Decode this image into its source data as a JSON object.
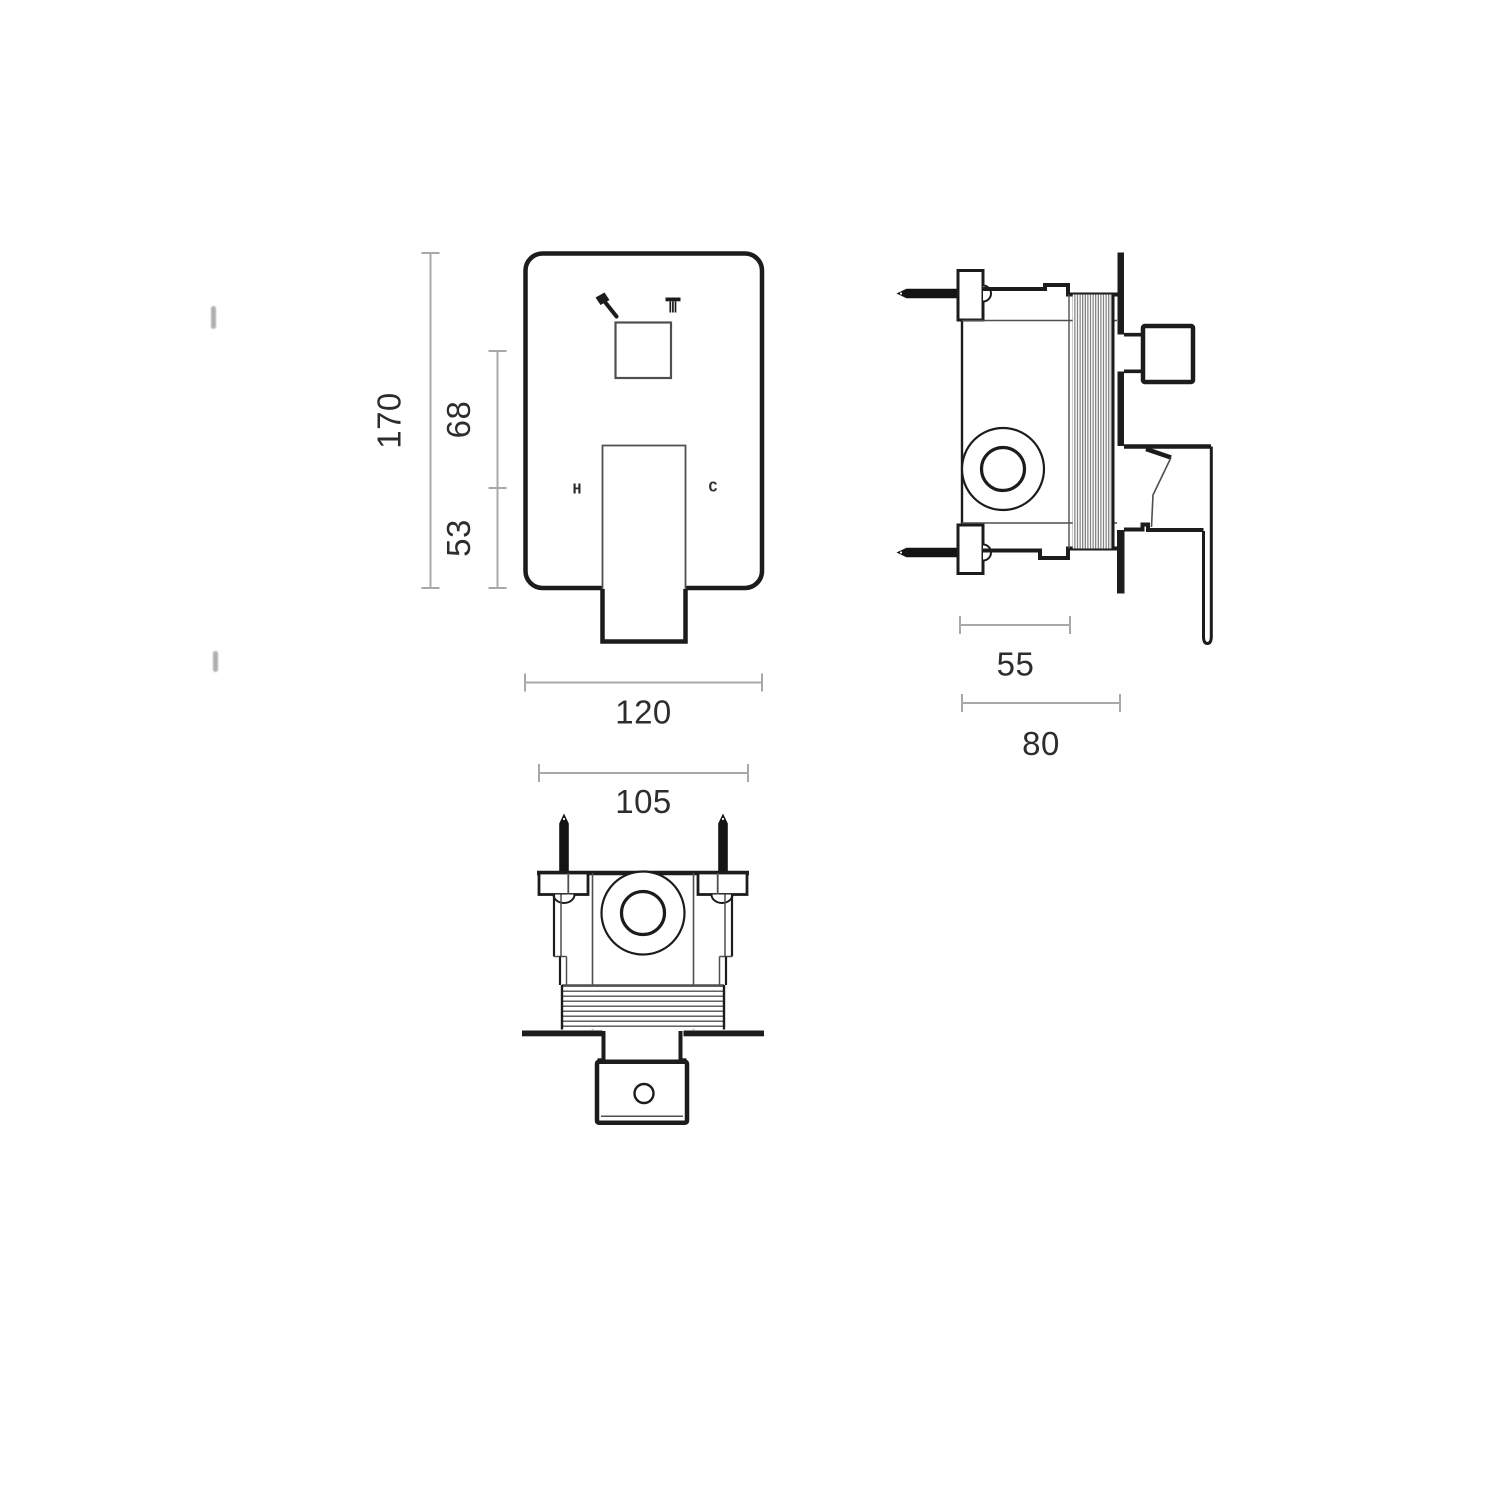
{
  "drawing_type": "technical-dimension-drawing",
  "subject": "concealed shower mixer with diverter - three orthographic views",
  "front_view": {
    "dim_total_height": "170",
    "dim_upper_segment": "68",
    "dim_lower_segment": "53",
    "dim_width": "120",
    "hot_label": "H",
    "cold_label": "C",
    "icons": [
      "handshower-icon",
      "overhead-shower-icon"
    ]
  },
  "side_view": {
    "dim_body_depth": "55",
    "dim_total_depth": "80"
  },
  "bottom_view": {
    "dim_mounting_width": "105"
  },
  "colors": {
    "line": "#1c1c1c",
    "line_soft": "#4f4f4f",
    "dim_line": "#a8a8a8",
    "text": "#2d2d2d",
    "screw": "#141414",
    "hatch": "#6f6f6f",
    "thread": "#474747",
    "background": "#ffffff"
  }
}
